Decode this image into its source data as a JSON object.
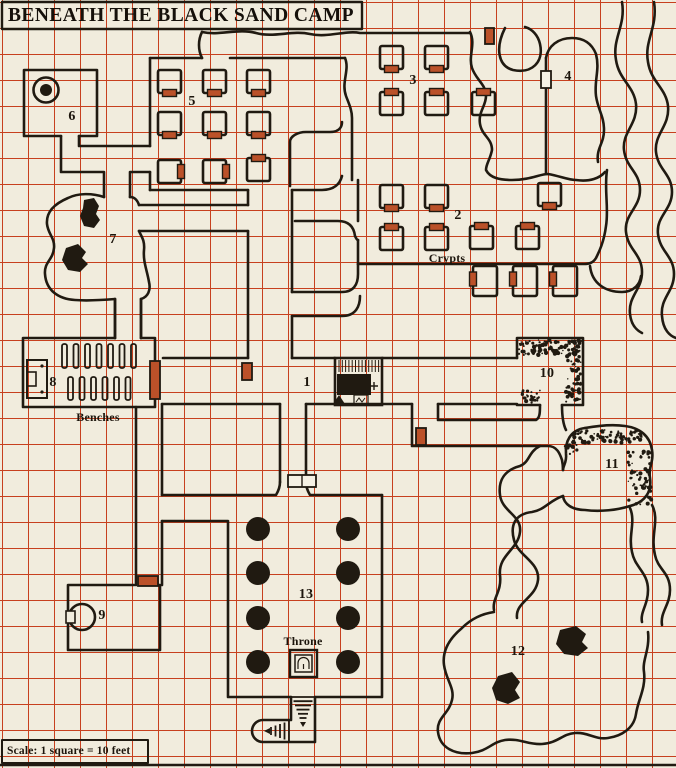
{
  "title": "BENEATH THE BLACK SAND CAMP",
  "scale_note": "Scale: 1 square = 10 feet",
  "colors": {
    "background": "#f1ecdd",
    "grid": "#c7401e",
    "ink": "#201a11",
    "door_fill": "#bb5129",
    "white_door_fill": "#f5f1e4"
  },
  "map": {
    "room_numbers": [
      {
        "id": "room-1",
        "label": "1",
        "x": 307,
        "y": 383
      },
      {
        "id": "room-2",
        "label": "2",
        "x": 458,
        "y": 216
      },
      {
        "id": "room-3",
        "label": "3",
        "x": 413,
        "y": 81
      },
      {
        "id": "room-4",
        "label": "4",
        "x": 568,
        "y": 77
      },
      {
        "id": "room-5",
        "label": "5",
        "x": 192,
        "y": 102
      },
      {
        "id": "room-6",
        "label": "6",
        "x": 72,
        "y": 117
      },
      {
        "id": "room-7",
        "label": "7",
        "x": 113,
        "y": 240
      },
      {
        "id": "room-8",
        "label": "8",
        "x": 53,
        "y": 383
      },
      {
        "id": "room-9",
        "label": "9",
        "x": 102,
        "y": 616
      },
      {
        "id": "room-10",
        "label": "10",
        "x": 547,
        "y": 374
      },
      {
        "id": "room-11",
        "label": "11",
        "x": 612,
        "y": 465
      },
      {
        "id": "room-12",
        "label": "12",
        "x": 518,
        "y": 652
      },
      {
        "id": "room-13",
        "label": "13",
        "x": 306,
        "y": 595
      }
    ],
    "feature_labels": [
      {
        "id": "crypts",
        "label": "Crypts",
        "x": 447,
        "y": 258
      },
      {
        "id": "benches",
        "label": "Benches",
        "x": 98,
        "y": 417
      },
      {
        "id": "throne",
        "label": "Throne",
        "x": 303,
        "y": 641
      }
    ],
    "symbols": [
      "well-icon",
      "pool-icon",
      "altar-dais-icon",
      "throne-icon",
      "bench-icon",
      "pillar-icon",
      "stairs-down-icon",
      "door-icon",
      "double-door-icon",
      "boulder-rubble-icon",
      "collapsed-rubble-icon"
    ]
  }
}
